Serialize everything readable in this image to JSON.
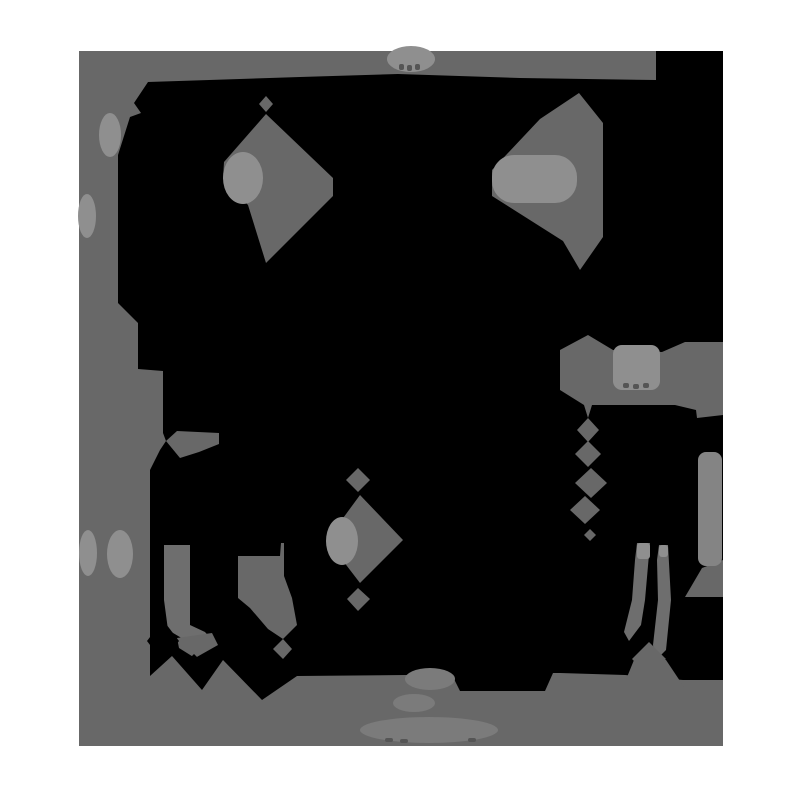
{
  "figure": {
    "kind": "posterized-photo",
    "description": "black animal silhouette on gray studio backdrop, quantized to flat gray levels, white page border",
    "canvas": {
      "w": 800,
      "h": 800
    },
    "colors": {
      "page": "#ffffff",
      "backdrop": "#686868",
      "black": "#000000",
      "light": "#8f8f8f",
      "soft": "#7b7b7b",
      "strip": "#848484",
      "leg": "#6e6e6e",
      "tick": "#555555"
    },
    "photo": {
      "x": 79,
      "y": 51,
      "w": 644,
      "h": 695
    },
    "shapes": [
      {
        "name": "backdrop-rect",
        "type": "rect",
        "fill": "backdrop",
        "x": 79,
        "y": 51,
        "w": 644,
        "h": 695,
        "r": 0
      },
      {
        "name": "animal-black-mass",
        "type": "polygon",
        "fill": "black",
        "pts": [
          [
            148,
            82
          ],
          [
            300,
            77
          ],
          [
            398,
            74
          ],
          [
            520,
            78
          ],
          [
            656,
            80
          ],
          [
            656,
            51
          ],
          [
            723,
            51
          ],
          [
            723,
            680
          ],
          [
            683,
            680
          ],
          [
            625,
            675
          ],
          [
            560,
            673
          ],
          [
            553,
            673
          ],
          [
            545,
            691
          ],
          [
            460,
            691
          ],
          [
            452,
            675
          ],
          [
            406,
            675
          ],
          [
            297,
            676
          ],
          [
            262,
            700
          ],
          [
            223,
            660
          ],
          [
            202,
            690
          ],
          [
            172,
            656
          ],
          [
            150,
            676
          ],
          [
            150,
            470
          ],
          [
            160,
            450
          ],
          [
            166,
            441
          ],
          [
            163,
            433
          ],
          [
            163,
            371
          ],
          [
            138,
            369
          ],
          [
            138,
            323
          ],
          [
            118,
            303
          ],
          [
            118,
            155
          ],
          [
            130,
            117
          ],
          [
            141,
            113
          ],
          [
            134,
            103
          ]
        ]
      },
      {
        "name": "small-diamond-above-left-kite",
        "type": "polygon",
        "fill": "backdrop",
        "pts": [
          [
            266,
            96
          ],
          [
            273,
            104
          ],
          [
            266,
            112
          ],
          [
            259,
            104
          ]
        ]
      },
      {
        "name": "left-kite-gap",
        "type": "polygon",
        "fill": "backdrop",
        "pts": [
          [
            266,
            114
          ],
          [
            333,
            178
          ],
          [
            333,
            196
          ],
          [
            299,
            230
          ],
          [
            266,
            263
          ],
          [
            248,
            205
          ],
          [
            223,
            179
          ],
          [
            224,
            162
          ]
        ]
      },
      {
        "name": "left-kite-highlight",
        "type": "ellipse",
        "fill": "light",
        "cx": 243,
        "cy": 178,
        "rx": 20,
        "ry": 26
      },
      {
        "name": "right-kite-gap",
        "type": "polygon",
        "fill": "backdrop",
        "pts": [
          [
            579,
            93
          ],
          [
            603,
            123
          ],
          [
            603,
            237
          ],
          [
            580,
            270
          ],
          [
            563,
            241
          ],
          [
            492,
            196
          ],
          [
            492,
            170
          ],
          [
            540,
            119
          ]
        ]
      },
      {
        "name": "right-kite-highlight",
        "type": "rect",
        "fill": "light",
        "x": 492,
        "y": 155,
        "w": 85,
        "h": 48,
        "r": 22
      },
      {
        "name": "right-mid-mass",
        "type": "polygon",
        "fill": "backdrop",
        "pts": [
          [
            588,
            335
          ],
          [
            613,
            350
          ],
          [
            662,
            352
          ],
          [
            685,
            342
          ],
          [
            723,
            342
          ],
          [
            723,
            415
          ],
          [
            697,
            418
          ],
          [
            696,
            410
          ],
          [
            675,
            405
          ],
          [
            592,
            405
          ],
          [
            588,
            418
          ],
          [
            584,
            405
          ],
          [
            560,
            390
          ],
          [
            560,
            350
          ]
        ]
      },
      {
        "name": "right-mid-highlight",
        "type": "rect",
        "fill": "light",
        "x": 613,
        "y": 345,
        "w": 47,
        "h": 45,
        "r": 9
      },
      {
        "name": "right-mid-ticks-1",
        "type": "rect",
        "fill": "tick",
        "x": 623,
        "y": 383,
        "w": 6,
        "h": 5,
        "r": 2
      },
      {
        "name": "right-mid-ticks-2",
        "type": "rect",
        "fill": "tick",
        "x": 633,
        "y": 384,
        "w": 6,
        "h": 5,
        "r": 2
      },
      {
        "name": "right-mid-ticks-3",
        "type": "rect",
        "fill": "tick",
        "x": 643,
        "y": 383,
        "w": 6,
        "h": 5,
        "r": 2
      },
      {
        "name": "chain-diamond-1",
        "type": "polygon",
        "fill": "backdrop",
        "pts": [
          [
            588,
            418
          ],
          [
            599,
            430
          ],
          [
            588,
            442
          ],
          [
            577,
            430
          ]
        ]
      },
      {
        "name": "chain-diamond-2",
        "type": "polygon",
        "fill": "backdrop",
        "pts": [
          [
            588,
            441
          ],
          [
            601,
            454
          ],
          [
            588,
            467
          ],
          [
            575,
            454
          ]
        ]
      },
      {
        "name": "chain-diamond-3",
        "type": "polygon",
        "fill": "backdrop",
        "pts": [
          [
            591,
            468
          ],
          [
            607,
            483
          ],
          [
            591,
            498
          ],
          [
            575,
            483
          ]
        ]
      },
      {
        "name": "chain-diamond-4",
        "type": "polygon",
        "fill": "backdrop",
        "pts": [
          [
            585,
            496
          ],
          [
            600,
            510
          ],
          [
            585,
            524
          ],
          [
            570,
            510
          ]
        ]
      },
      {
        "name": "chain-diamond-5",
        "type": "polygon",
        "fill": "backdrop",
        "pts": [
          [
            590,
            529
          ],
          [
            596,
            535
          ],
          [
            590,
            541
          ],
          [
            584,
            535
          ]
        ]
      },
      {
        "name": "mid-diamond-small-top",
        "type": "polygon",
        "fill": "backdrop",
        "pts": [
          [
            358,
            468
          ],
          [
            370,
            480
          ],
          [
            358,
            492
          ],
          [
            346,
            480
          ]
        ]
      },
      {
        "name": "mid-diamond-large",
        "type": "polygon",
        "fill": "backdrop",
        "pts": [
          [
            360,
            495
          ],
          [
            403,
            540
          ],
          [
            360,
            583
          ],
          [
            327,
            540
          ]
        ]
      },
      {
        "name": "mid-diamond-highlight",
        "type": "ellipse",
        "fill": "light",
        "cx": 342,
        "cy": 541,
        "rx": 16,
        "ry": 24
      },
      {
        "name": "mid-diamond-small-bottom",
        "type": "polygon",
        "fill": "backdrop",
        "pts": [
          [
            358,
            588
          ],
          [
            370,
            599
          ],
          [
            358,
            611
          ],
          [
            347,
            599
          ]
        ]
      },
      {
        "name": "left-pocket-gap",
        "type": "polygon",
        "fill": "backdrop",
        "pts": [
          [
            238,
            556
          ],
          [
            280,
            556
          ],
          [
            281,
            543
          ],
          [
            284,
            543
          ],
          [
            284,
            576
          ],
          [
            292,
            598
          ],
          [
            297,
            625
          ],
          [
            283,
            639
          ],
          [
            268,
            629
          ],
          [
            250,
            608
          ],
          [
            238,
            598
          ]
        ]
      },
      {
        "name": "left-pocket-diamond",
        "type": "polygon",
        "fill": "backdrop",
        "pts": [
          [
            283,
            639
          ],
          [
            292,
            649
          ],
          [
            283,
            659
          ],
          [
            273,
            649
          ]
        ]
      },
      {
        "name": "left-x-wedge",
        "type": "polygon",
        "fill": "backdrop",
        "pts": [
          [
            166,
            441
          ],
          [
            177,
            431
          ],
          [
            219,
            433
          ],
          [
            219,
            444
          ],
          [
            199,
            452
          ],
          [
            180,
            458
          ]
        ]
      },
      {
        "name": "front-leg-strip",
        "type": "polygon",
        "fill": "leg",
        "pts": [
          [
            164,
            545
          ],
          [
            190,
            545
          ],
          [
            190,
            625
          ],
          [
            205,
            632
          ],
          [
            213,
            641
          ],
          [
            190,
            643
          ],
          [
            168,
            630
          ],
          [
            164,
            600
          ]
        ]
      },
      {
        "name": "front-paw-wedge",
        "type": "polygon",
        "fill": "backdrop",
        "pts": [
          [
            177,
            638
          ],
          [
            212,
            633
          ],
          [
            218,
            645
          ],
          [
            195,
            658
          ],
          [
            179,
            648
          ]
        ]
      },
      {
        "name": "hind-leg-strip-1",
        "type": "polygon",
        "fill": "leg",
        "pts": [
          [
            637,
            543
          ],
          [
            650,
            543
          ],
          [
            645,
            600
          ],
          [
            641,
            625
          ],
          [
            629,
            641
          ],
          [
            624,
            632
          ],
          [
            632,
            600
          ],
          [
            635,
            560
          ]
        ]
      },
      {
        "name": "hind-leg-strip-2",
        "type": "polygon",
        "fill": "leg",
        "pts": [
          [
            659,
            545
          ],
          [
            668,
            545
          ],
          [
            671,
            600
          ],
          [
            666,
            650
          ],
          [
            656,
            660
          ],
          [
            653,
            645
          ],
          [
            658,
            600
          ],
          [
            657,
            560
          ]
        ]
      },
      {
        "name": "hind-leg-strip-1-cap",
        "type": "rect",
        "fill": "light",
        "x": 637,
        "y": 543,
        "w": 13,
        "h": 16,
        "r": 3
      },
      {
        "name": "hind-leg-strip-2-cap",
        "type": "rect",
        "fill": "light",
        "x": 659,
        "y": 545,
        "w": 9,
        "h": 12,
        "r": 3
      },
      {
        "name": "hind-x-diamond",
        "type": "polygon",
        "fill": "backdrop",
        "pts": [
          [
            649,
            642
          ],
          [
            666,
            659
          ],
          [
            649,
            676
          ],
          [
            632,
            659
          ]
        ]
      },
      {
        "name": "hind-shadow-trapezoid",
        "type": "polygon",
        "fill": "backdrop",
        "pts": [
          [
            634,
            660
          ],
          [
            666,
            660
          ],
          [
            684,
            687
          ],
          [
            623,
            687
          ]
        ]
      },
      {
        "name": "right-edge-wedge",
        "type": "polygon",
        "fill": "backdrop",
        "pts": [
          [
            723,
            560
          ],
          [
            723,
            597
          ],
          [
            685,
            597
          ],
          [
            702,
            568
          ]
        ]
      },
      {
        "name": "right-edge-strip",
        "type": "rect",
        "fill": "strip",
        "x": 698,
        "y": 452,
        "w": 24,
        "h": 114,
        "r": 8
      },
      {
        "name": "front-x-diamond-black",
        "type": "polygon",
        "fill": "black",
        "pts": [
          [
            163,
            620
          ],
          [
            179,
            641
          ],
          [
            163,
            662
          ],
          [
            147,
            641
          ]
        ]
      },
      {
        "name": "front-x-dot-black",
        "type": "polygon",
        "fill": "black",
        "pts": [
          [
            194,
            654
          ],
          [
            199,
            659
          ],
          [
            194,
            664
          ],
          [
            189,
            659
          ]
        ]
      },
      {
        "name": "backdrop-hump-highlight",
        "type": "ellipse",
        "fill": "light",
        "cx": 411,
        "cy": 59,
        "rx": 24,
        "ry": 13
      },
      {
        "name": "hump-tick-1",
        "type": "rect",
        "fill": "tick",
        "x": 399,
        "y": 64,
        "w": 5,
        "h": 6,
        "r": 2
      },
      {
        "name": "hump-tick-2",
        "type": "rect",
        "fill": "tick",
        "x": 407,
        "y": 65,
        "w": 5,
        "h": 6,
        "r": 2
      },
      {
        "name": "hump-tick-3",
        "type": "rect",
        "fill": "tick",
        "x": 415,
        "y": 64,
        "w": 5,
        "h": 6,
        "r": 2
      },
      {
        "name": "left-edge-blob-1",
        "type": "ellipse",
        "fill": "light",
        "cx": 110,
        "cy": 135,
        "rx": 11,
        "ry": 22
      },
      {
        "name": "left-edge-blob-2",
        "type": "ellipse",
        "fill": "light",
        "cx": 87,
        "cy": 216,
        "rx": 9,
        "ry": 22
      },
      {
        "name": "left-edge-blob-3",
        "type": "ellipse",
        "fill": "light",
        "cx": 88,
        "cy": 553,
        "rx": 9,
        "ry": 23
      },
      {
        "name": "left-edge-blob-4",
        "type": "ellipse",
        "fill": "light",
        "cx": 120,
        "cy": 554,
        "rx": 13,
        "ry": 24
      },
      {
        "name": "ground-blob-1",
        "type": "ellipse",
        "fill": "soft",
        "cx": 430,
        "cy": 679,
        "rx": 25,
        "ry": 11
      },
      {
        "name": "ground-blob-2",
        "type": "ellipse",
        "fill": "soft",
        "cx": 414,
        "cy": 703,
        "rx": 21,
        "ry": 9
      },
      {
        "name": "ground-blob-watermark",
        "type": "ellipse",
        "fill": "soft",
        "cx": 429,
        "cy": 730,
        "rx": 69,
        "ry": 13
      },
      {
        "name": "ground-tick-1",
        "type": "rect",
        "fill": "tick",
        "x": 385,
        "y": 738,
        "w": 8,
        "h": 4,
        "r": 2
      },
      {
        "name": "ground-tick-2",
        "type": "rect",
        "fill": "tick",
        "x": 400,
        "y": 739,
        "w": 8,
        "h": 4,
        "r": 2
      },
      {
        "name": "ground-tick-3",
        "type": "rect",
        "fill": "tick",
        "x": 468,
        "y": 738,
        "w": 8,
        "h": 4,
        "r": 2
      }
    ]
  }
}
